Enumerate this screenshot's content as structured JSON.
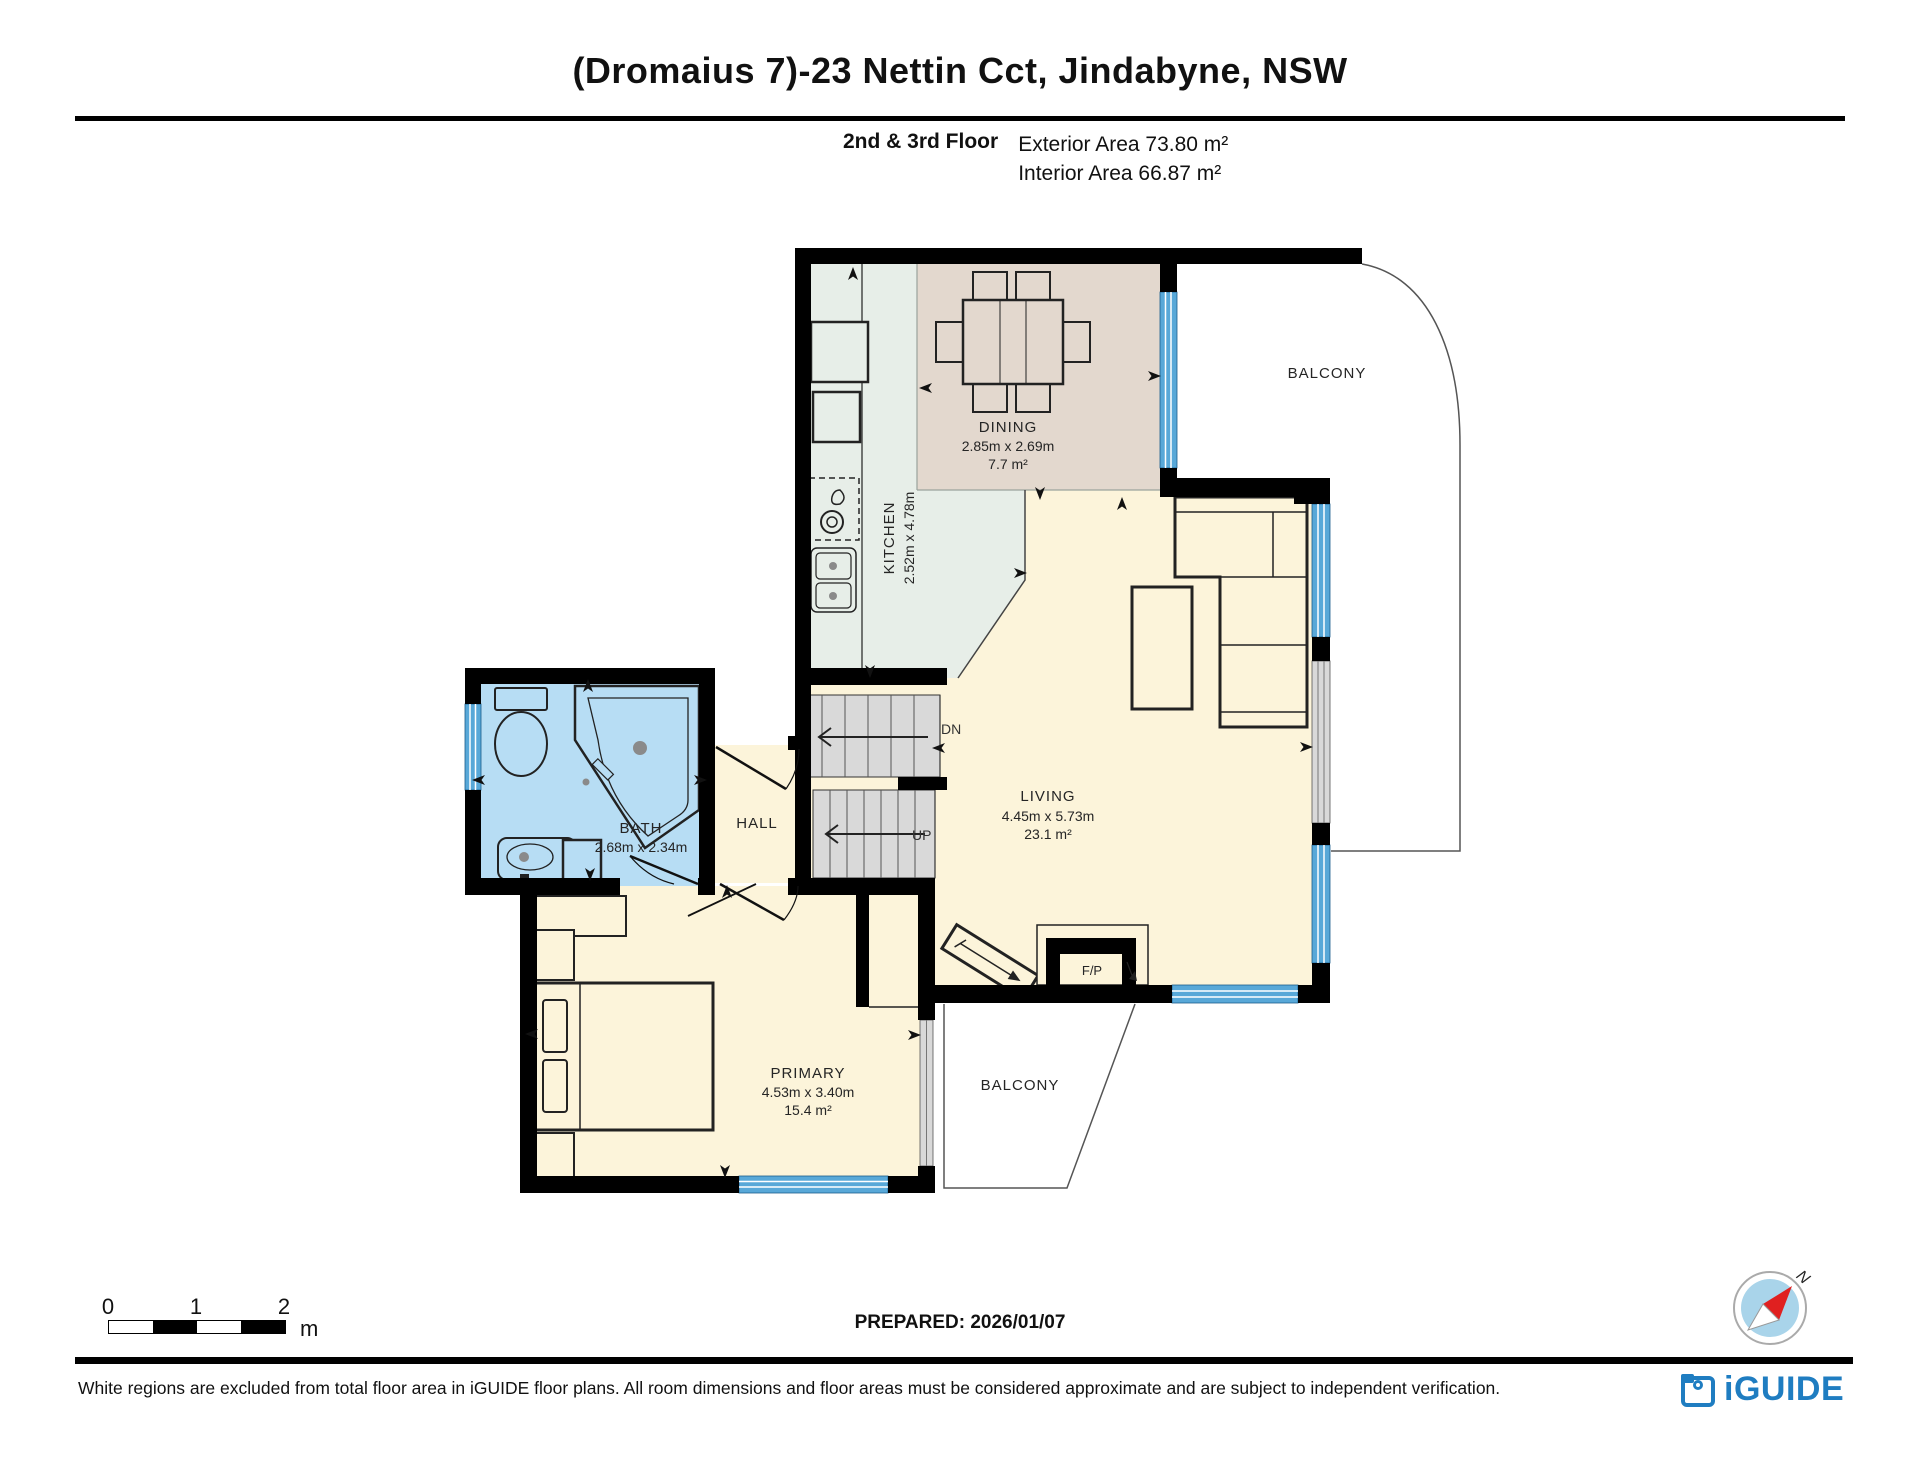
{
  "header": {
    "title": "(Dromaius 7)-23 Nettin Cct, Jindabyne, NSW"
  },
  "floor_info": {
    "floor_label": "2nd & 3rd Floor",
    "exterior": "Exterior Area 73.80 m²",
    "interior": "Interior Area 66.87 m²"
  },
  "rooms": {
    "dining": {
      "name": "DINING",
      "dims": "2.85m x 2.69m",
      "area": "7.7 m²"
    },
    "kitchen": {
      "name": "KITCHEN",
      "dims": "2.52m x 4.78m"
    },
    "living": {
      "name": "LIVING",
      "dims": "4.45m x 5.73m",
      "area": "23.1 m²"
    },
    "bath": {
      "name": "BATH",
      "dims": "2.68m x 2.34m"
    },
    "hall": {
      "name": "HALL"
    },
    "primary": {
      "name": "PRIMARY",
      "dims": "4.53m x 3.40m",
      "area": "15.4 m²"
    },
    "balcony_upper": {
      "name": "BALCONY"
    },
    "balcony_lower": {
      "name": "BALCONY"
    },
    "fireplace": {
      "label": "F/P"
    }
  },
  "stairs": {
    "down_label": "DN",
    "up_label": "UP"
  },
  "scale_bar": {
    "ticks": [
      "0",
      "1",
      "2"
    ],
    "unit": "m"
  },
  "prepared_label": "PREPARED: 2026/01/07",
  "compass": {
    "north_label": "N"
  },
  "footer": {
    "disclaimer": "White regions are excluded from total floor area in iGUIDE floor plans. All room dimensions and floor areas must be considered approximate and are subject to independent verification."
  },
  "brand": {
    "logo_text": "iGUIDE"
  },
  "colors": {
    "wall": "#000000",
    "kitchen_floor": "#e7eee8",
    "dining_floor": "#e3d8ce",
    "living_floor": "#fcf4da",
    "bath_floor": "#b7ddf4",
    "stairs_gray": "#d9d9d9",
    "window_blue": "#58a8d8",
    "brand_blue": "#1f7dc1",
    "compass_red": "#e02020",
    "compass_disc": "#a9d4ea"
  }
}
